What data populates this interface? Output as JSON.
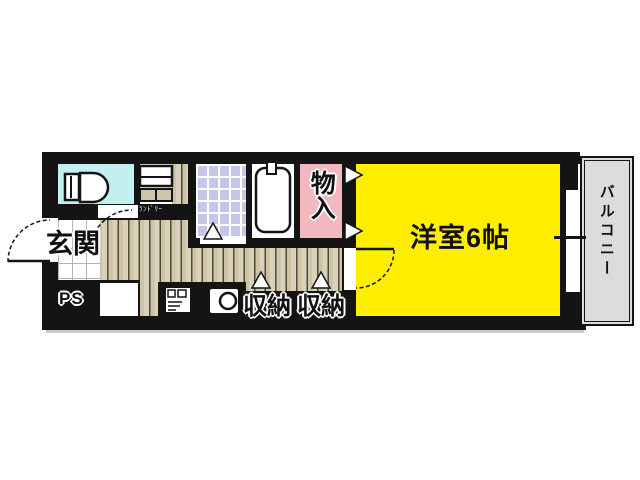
{
  "floorplan": {
    "labels": {
      "entrance": "玄関",
      "pipe_space": "PS",
      "laundry": "ﾗﾝﾄﾞﾘｰ",
      "closet": "物入",
      "main_room": "洋室6帖",
      "storage_left": "収納",
      "storage_right": "収納",
      "balcony": "バルコニー"
    },
    "colors": {
      "wall": "#141414",
      "main_room": "#ffee00",
      "toilet_room": "#c2efef",
      "bath_room": "#ffffff",
      "closet_room": "#f2b8c0",
      "balcony": "#dcdcdc",
      "flooring": "#cdc4a6"
    }
  }
}
